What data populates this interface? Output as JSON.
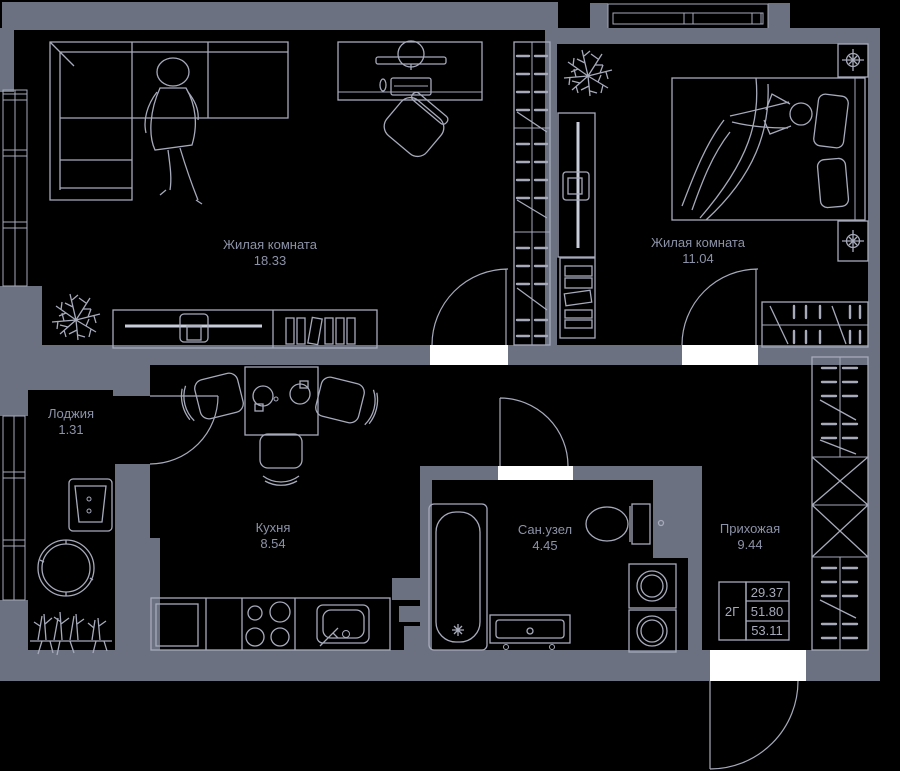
{
  "colors": {
    "bg": "#000000",
    "wall": "#6c7182",
    "line": "#a6aabb",
    "line_bright": "#c9ccda",
    "text": "#8c92a8",
    "opening": "#ffffff"
  },
  "rooms": [
    {
      "id": "living",
      "name": "Жилая комната",
      "area": "18.33"
    },
    {
      "id": "bedroom",
      "name": "Жилая комната",
      "area": "11.04"
    },
    {
      "id": "kitchen",
      "name": "Кухня",
      "area": "8.54"
    },
    {
      "id": "bathroom",
      "name": "Сан.узел",
      "area": "4.45"
    },
    {
      "id": "hallway",
      "name": "Прихожая",
      "area": "9.44"
    },
    {
      "id": "loggia",
      "name": "Лоджия",
      "area": "1.31"
    }
  ],
  "info_box": {
    "label": "2Г",
    "values": [
      "29.37",
      "51.80",
      "53.11"
    ]
  }
}
